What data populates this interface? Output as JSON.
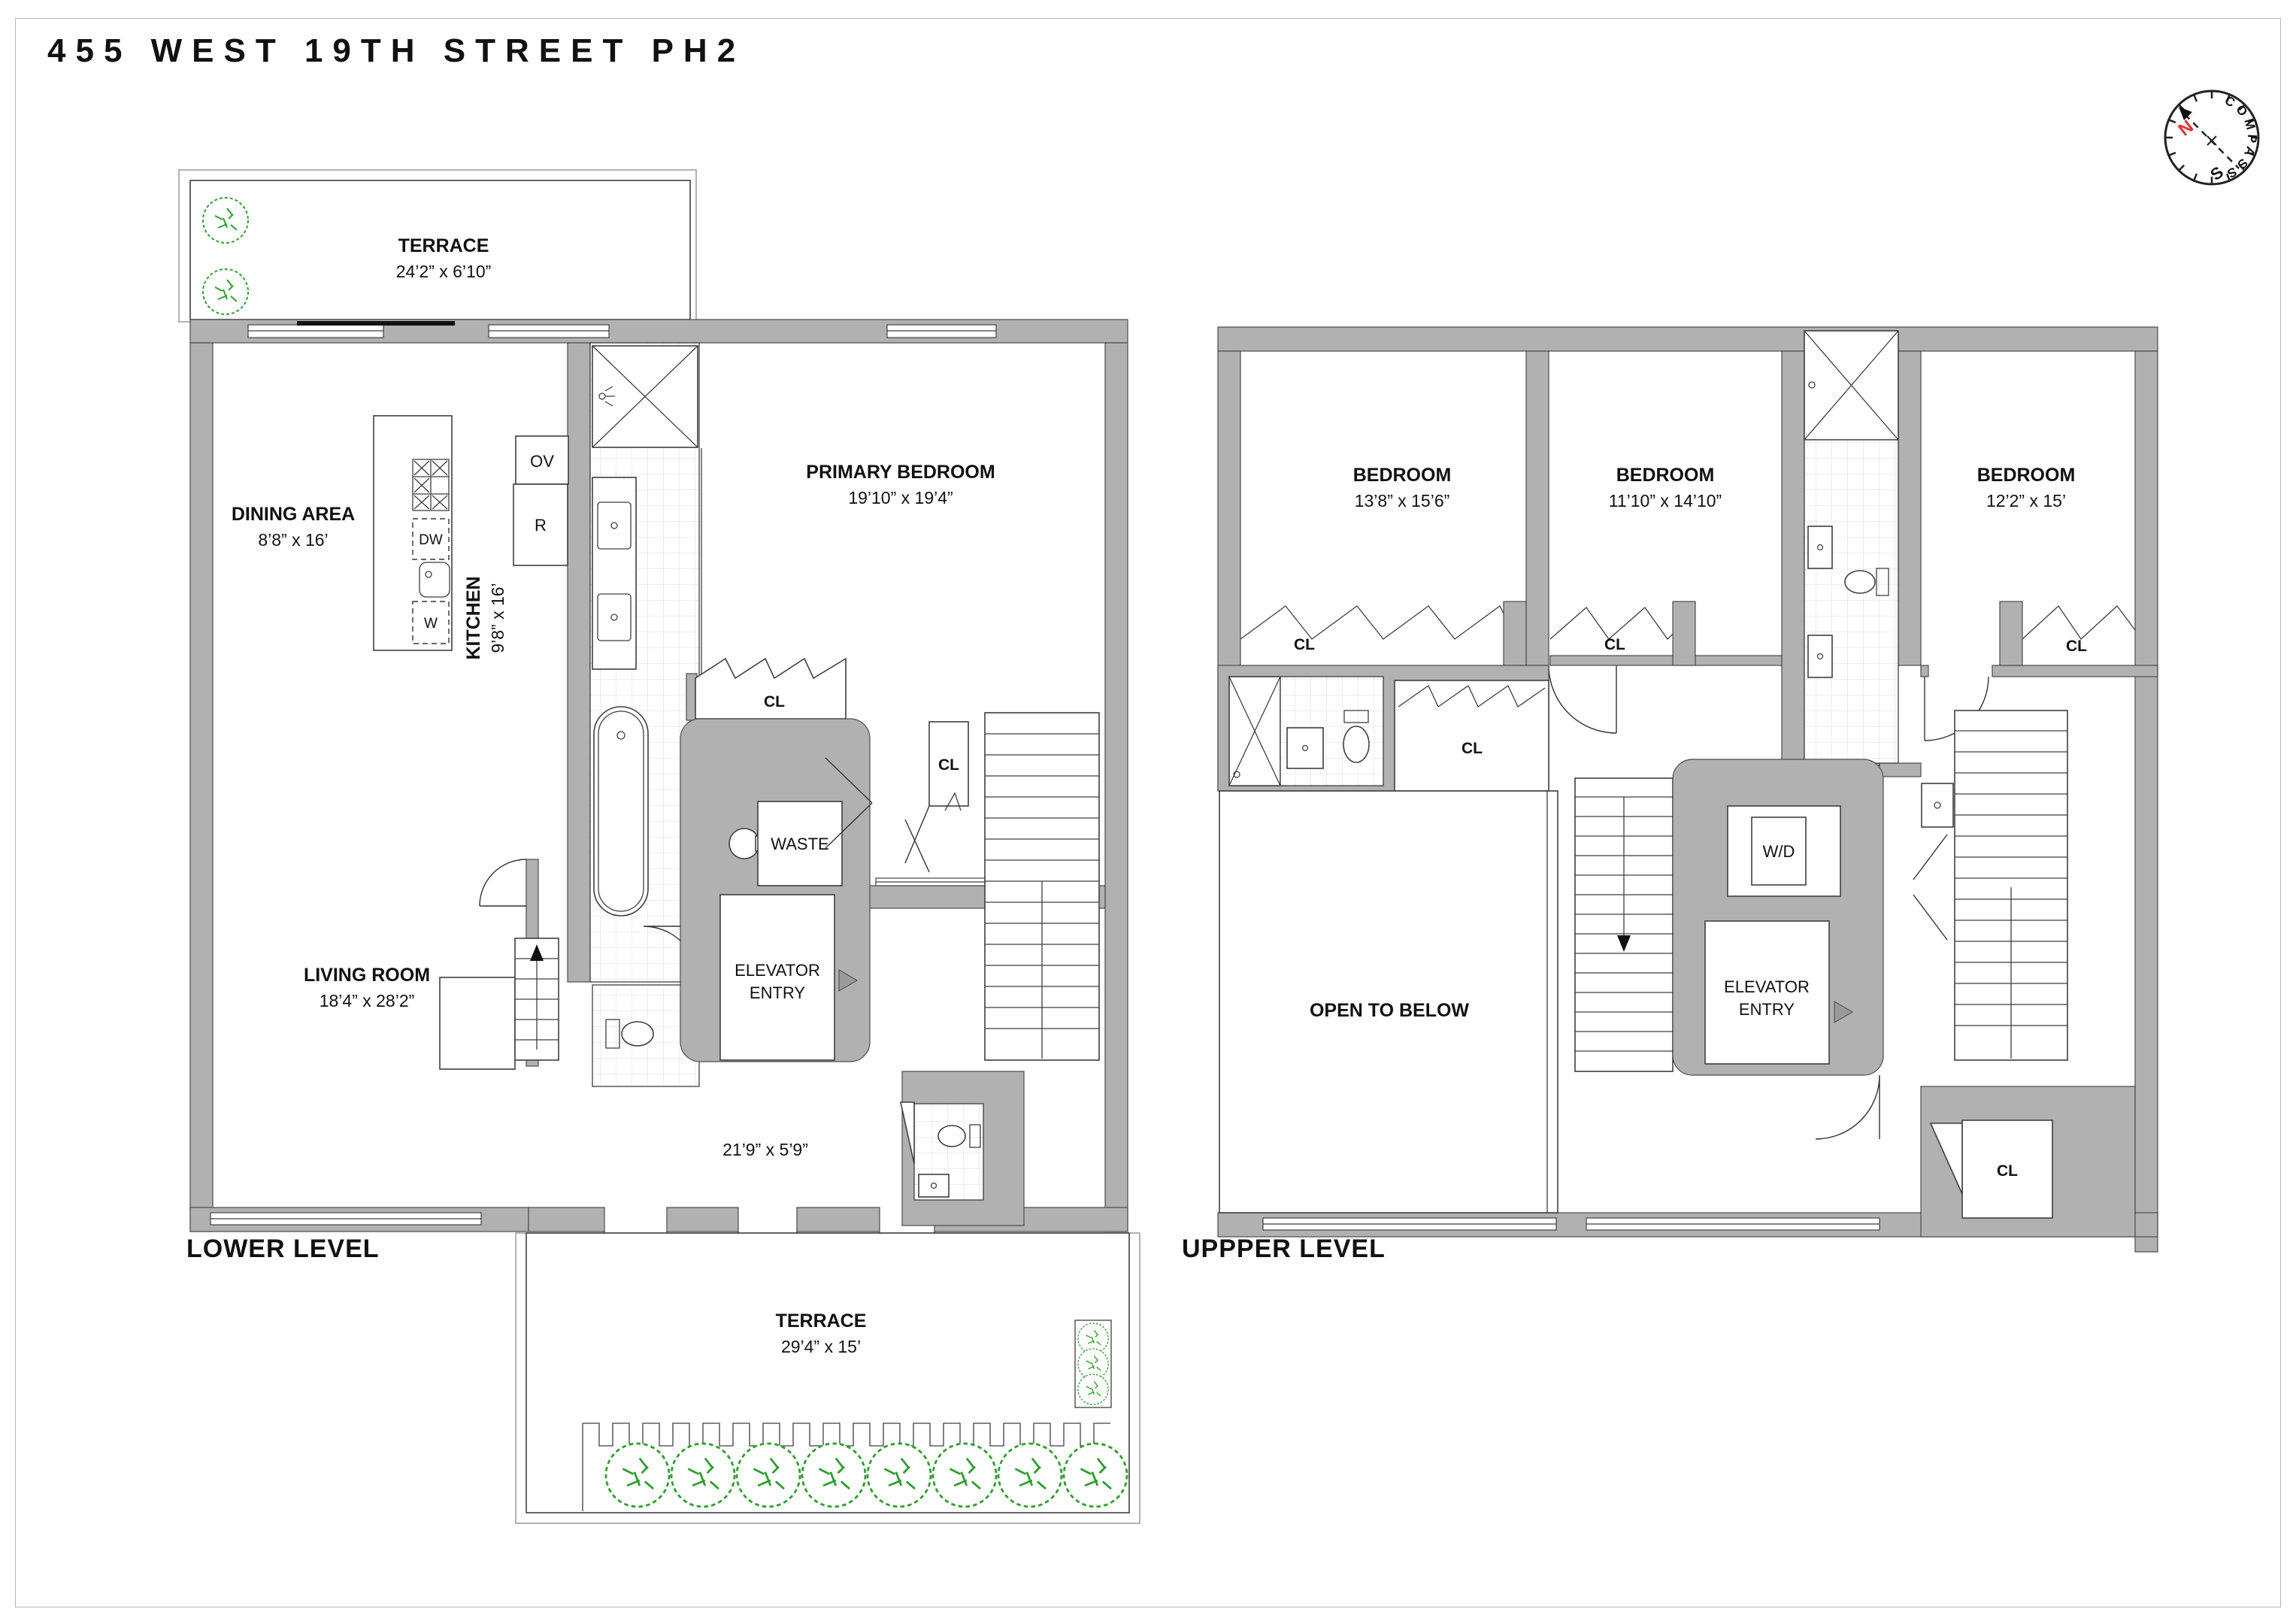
{
  "title": "455 WEST 19TH STREET PH2",
  "compass": {
    "name": "COMPASS",
    "n": "N",
    "s": "S"
  },
  "labels": {
    "cl": "CL"
  },
  "lower": {
    "name": "LOWER LEVEL",
    "terrace_top": {
      "label": "TERRACE",
      "dim": "24’2” x 6’10”"
    },
    "dining": {
      "label": "DINING AREA",
      "dim": "8’8” x 16’"
    },
    "kitchen": {
      "label": "KITCHEN",
      "dim": "9’8” x 16’"
    },
    "primary_bedroom": {
      "label": "PRIMARY BEDROOM",
      "dim": "19’10” x 19’4”"
    },
    "living": {
      "label": "LIVING ROOM",
      "dim": "18’4” x 28’2”"
    },
    "hall_dim": "21’9” x 5’9”",
    "waste": "WASTE",
    "elevator1": "ELEVATOR",
    "elevator2": "ENTRY",
    "terrace_bottom": {
      "label": "TERRACE",
      "dim": "29’4” x 15’"
    },
    "ov": "OV",
    "r": "R",
    "dw": "DW",
    "w": "W"
  },
  "upper": {
    "name": "UPPPER LEVEL",
    "bed1": {
      "label": "BEDROOM",
      "dim": "13’8” x 15’6”"
    },
    "bed2": {
      "label": "BEDROOM",
      "dim": "11’10” x 14’10”"
    },
    "bed3": {
      "label": "BEDROOM",
      "dim": "12’2” x 15’"
    },
    "open": "OPEN TO BELOW",
    "wd": "W/D",
    "elevator1": "ELEVATOR",
    "elevator2": "ENTRY"
  }
}
